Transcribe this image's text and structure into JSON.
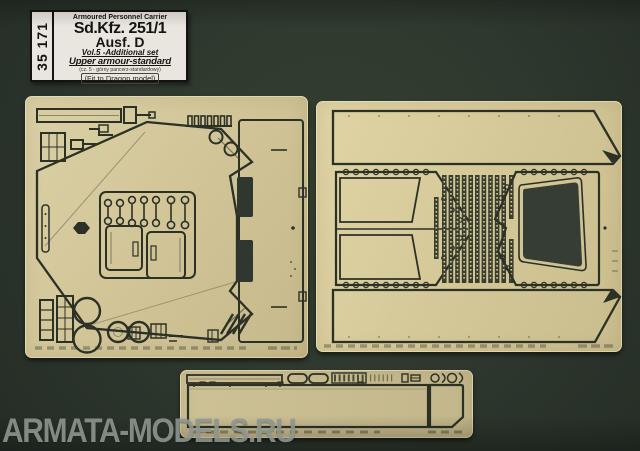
{
  "label": {
    "code": "35 171",
    "series": "Armoured Personnel Carrier",
    "title": "Sd.Kfz. 251/1",
    "variant": "Ausf. D",
    "set_info": "Vol.5 -Additional set",
    "set_name": "Upper armour-standard",
    "set_name_alt": "(cz. 5 - górny pancerz-standardowy)",
    "fit_note": "(Fit to Dragon model)"
  },
  "watermark": {
    "text": "ARMATA-MODELS.RU",
    "color": "#949c96"
  },
  "colors": {
    "background": "#2e382e",
    "brass": "#d2c699",
    "etch_line": "#2c3126",
    "cutout": "#353d35",
    "label_background": "#e9e6df"
  }
}
